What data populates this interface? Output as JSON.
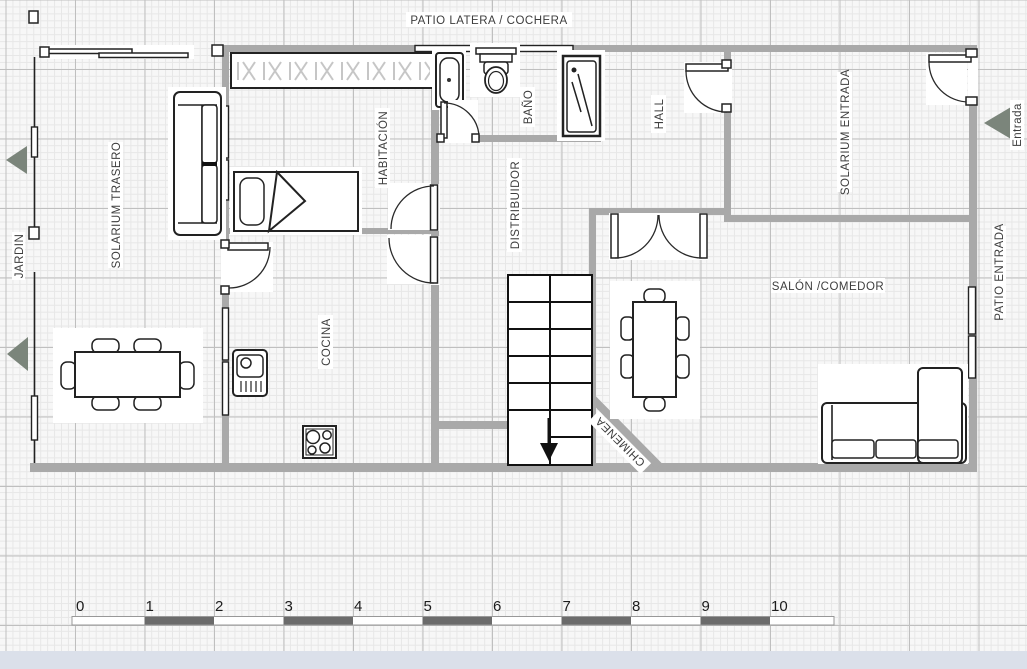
{
  "plan": {
    "exterior_labels": {
      "patio_top": "PATIO LATERA / COCHERA",
      "jardin": "JARDIN",
      "entrada": "Entrada",
      "patio_entrada": "PATIO ENTRADA"
    },
    "rooms": [
      {
        "name": "SOLARIUM TRASERO"
      },
      {
        "name": "HABITACIÓN"
      },
      {
        "name": "BAÑO"
      },
      {
        "name": "HALL"
      },
      {
        "name": "SOLARIUM ENTRADA"
      },
      {
        "name": "DISTRIBUIDOR"
      },
      {
        "name": "COCINA"
      },
      {
        "name": "SALÓN /COMEDOR"
      }
    ],
    "features": {
      "fireplace": "CHIMENEA"
    },
    "scale_ruler": {
      "unit_labels": [
        "0",
        "1",
        "2",
        "3",
        "4",
        "5",
        "6",
        "7",
        "8",
        "9",
        "10"
      ]
    }
  },
  "colors": {
    "wall": "#a9a9a9",
    "entry_arrow": "#7b857b",
    "label_text": "#3d3d3d",
    "ruler_dark": "#6b6b6b",
    "frame_strip": "#dbe0ea"
  }
}
